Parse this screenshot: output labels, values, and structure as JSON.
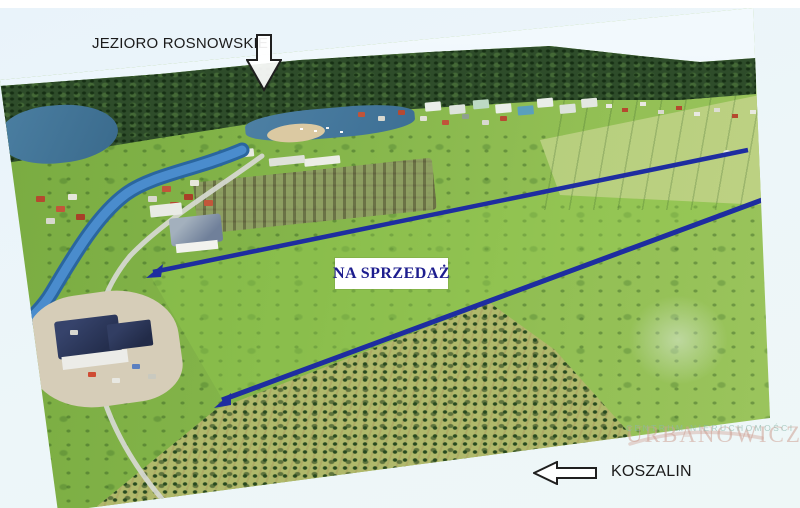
{
  "annotations": {
    "lake": {
      "label": "JEZIORO ROSNOWSKIE",
      "arrow_direction": "down"
    },
    "for_sale": {
      "label": "NA SPRZEDAŻ"
    },
    "city": {
      "label": "KOSZALIN",
      "arrow_direction": "left"
    },
    "watermark": {
      "name": "URBANOWICZ",
      "tagline": "CENTRUM NIERUCHOMOŚCI"
    }
  },
  "colors": {
    "boundary_line": "#1e2da0",
    "sale_label_text": "#1d1d8e",
    "annotation_text": "#1b1b1b",
    "watermark_name": "#d9b3a9",
    "watermark_tagline": "#9fc5ba",
    "sky": "#d5e9f6",
    "meadow": "#7cb045",
    "forest": "#2e4c2a",
    "water": "#3e7fc0"
  }
}
